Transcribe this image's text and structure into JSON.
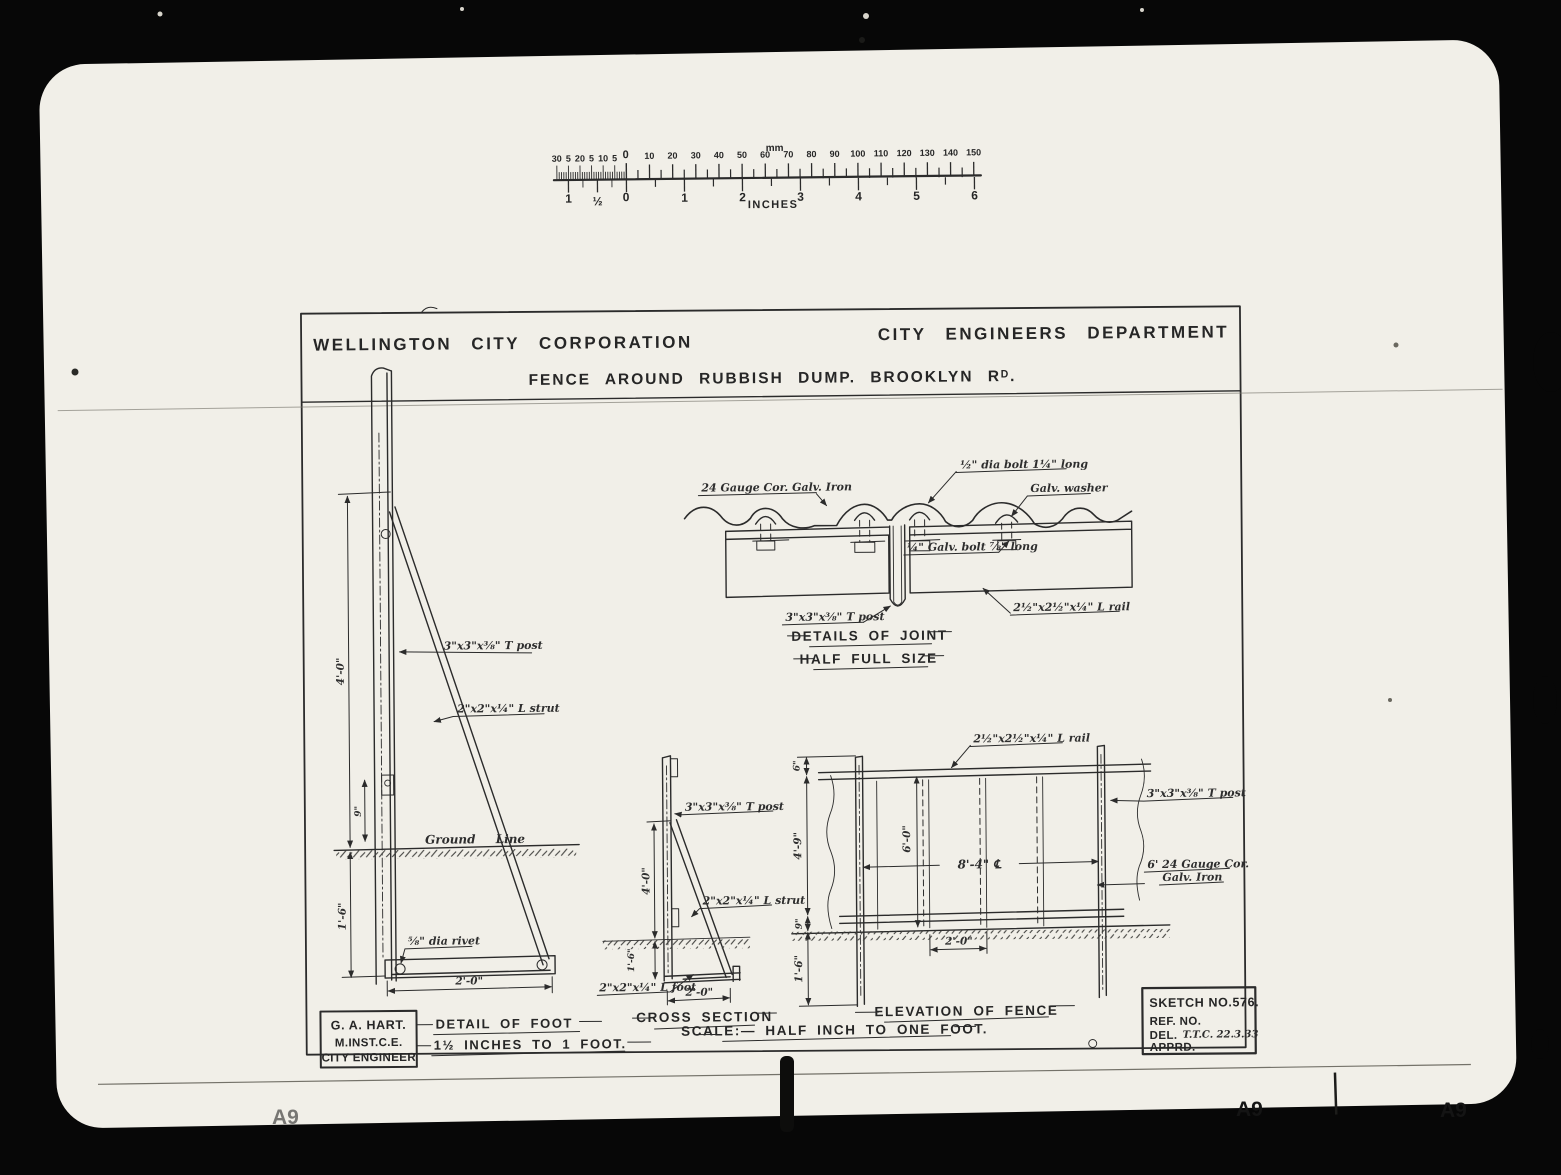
{
  "colors": {
    "paper": "#f1efe8",
    "ink": "#2b2b2b",
    "frame": "#070707"
  },
  "ruler": {
    "unit_top": "mm",
    "unit_bottom": "INCHES",
    "zero_top": "0",
    "zero_bottom": "0",
    "mm_left_out": [
      "5",
      "10",
      "5",
      "20",
      "5",
      "30"
    ],
    "mm_right": [
      "10",
      "20",
      "30",
      "40",
      "50",
      "60",
      "70",
      "80",
      "90",
      "100",
      "110",
      "120",
      "130",
      "140",
      "150"
    ],
    "inch_left_out": [
      "½",
      "1"
    ],
    "inch_right": [
      "1",
      "2",
      "3",
      "4",
      "5",
      "6"
    ]
  },
  "title_block": {
    "company": "WELLINGTON CITY CORPORATION",
    "department": "CITY ENGINEERS DEPARTMENT",
    "subject": "FENCE AROUND RUBBISH DUMP. BROOKLYN Rᴰ."
  },
  "joint_detail": {
    "iron": "24 Gauge Cor. Galv. Iron",
    "bolt_top": "½\" dia bolt 1¼\" long",
    "washer": "Galv. washer",
    "bolt_mid": "¼\" Galv. bolt ⅞\" long",
    "t_post": "3\"x3\"x⅜\" T post",
    "l_rail": "2½\"x2½\"x¼\" L rail",
    "caption": "DETAILS OF JOINT",
    "subcaption": "HALF FULL SIZE"
  },
  "detail_of_foot": {
    "dim_height": "4'-0\"",
    "dim_9": "9\"",
    "dim_depth": "1'-6\"",
    "dim_width": "2'-0\"",
    "t_post": "3\"x3\"x⅜\" T post",
    "l_strut": "2\"x2\"x¼\" L strut",
    "ground": "Ground Line",
    "rivet": "⅝\" dia rivet",
    "caption": "DETAIL OF FOOT",
    "scale": "1½ INCHES TO 1 FOOT."
  },
  "cross_section": {
    "dim_height": "4'-0\"",
    "dim_depth": "1'-6\"",
    "dim_width": "2'-0\"",
    "t_post": "3\"x3\"x⅜\" T post",
    "l_strut": "2\"x2\"x¼\" L strut",
    "l_foot": "2\"x2\"x¼\" L foot",
    "caption": "CROSS SECTION"
  },
  "elevation": {
    "dim_6": "6\"",
    "dim_4_9": "4'-9\"",
    "dim_9": "9\"",
    "dim_1_6": "1'-6\"",
    "dim_6_0": "6'-0\"",
    "dim_8_4": "8'-4\" ℄",
    "dim_2_0": "2'-0\"",
    "l_rail": "2½\"x2½\"x¼\" L rail",
    "t_post": "3\"x3\"x⅜\" T post",
    "iron_line1": "6' 24 Gauge Cor.",
    "iron_line2": "Galv. Iron",
    "caption": "ELEVATION OF FENCE",
    "scale": "SCALE:— HALF INCH TO ONE FOOT."
  },
  "engineer_box": {
    "name": "G. A. HART.",
    "qualification": "M.INST.C.E.",
    "title": "CITY ENGINEER"
  },
  "sketch_box": {
    "sketch_no": "SKETCH NO.576.",
    "ref": "REF. NO.",
    "del": "DEL.",
    "del_value": "T.T.C. 22.3.33",
    "apprd": "APPRD."
  },
  "artifacts": {
    "corner_mark": "A9"
  }
}
